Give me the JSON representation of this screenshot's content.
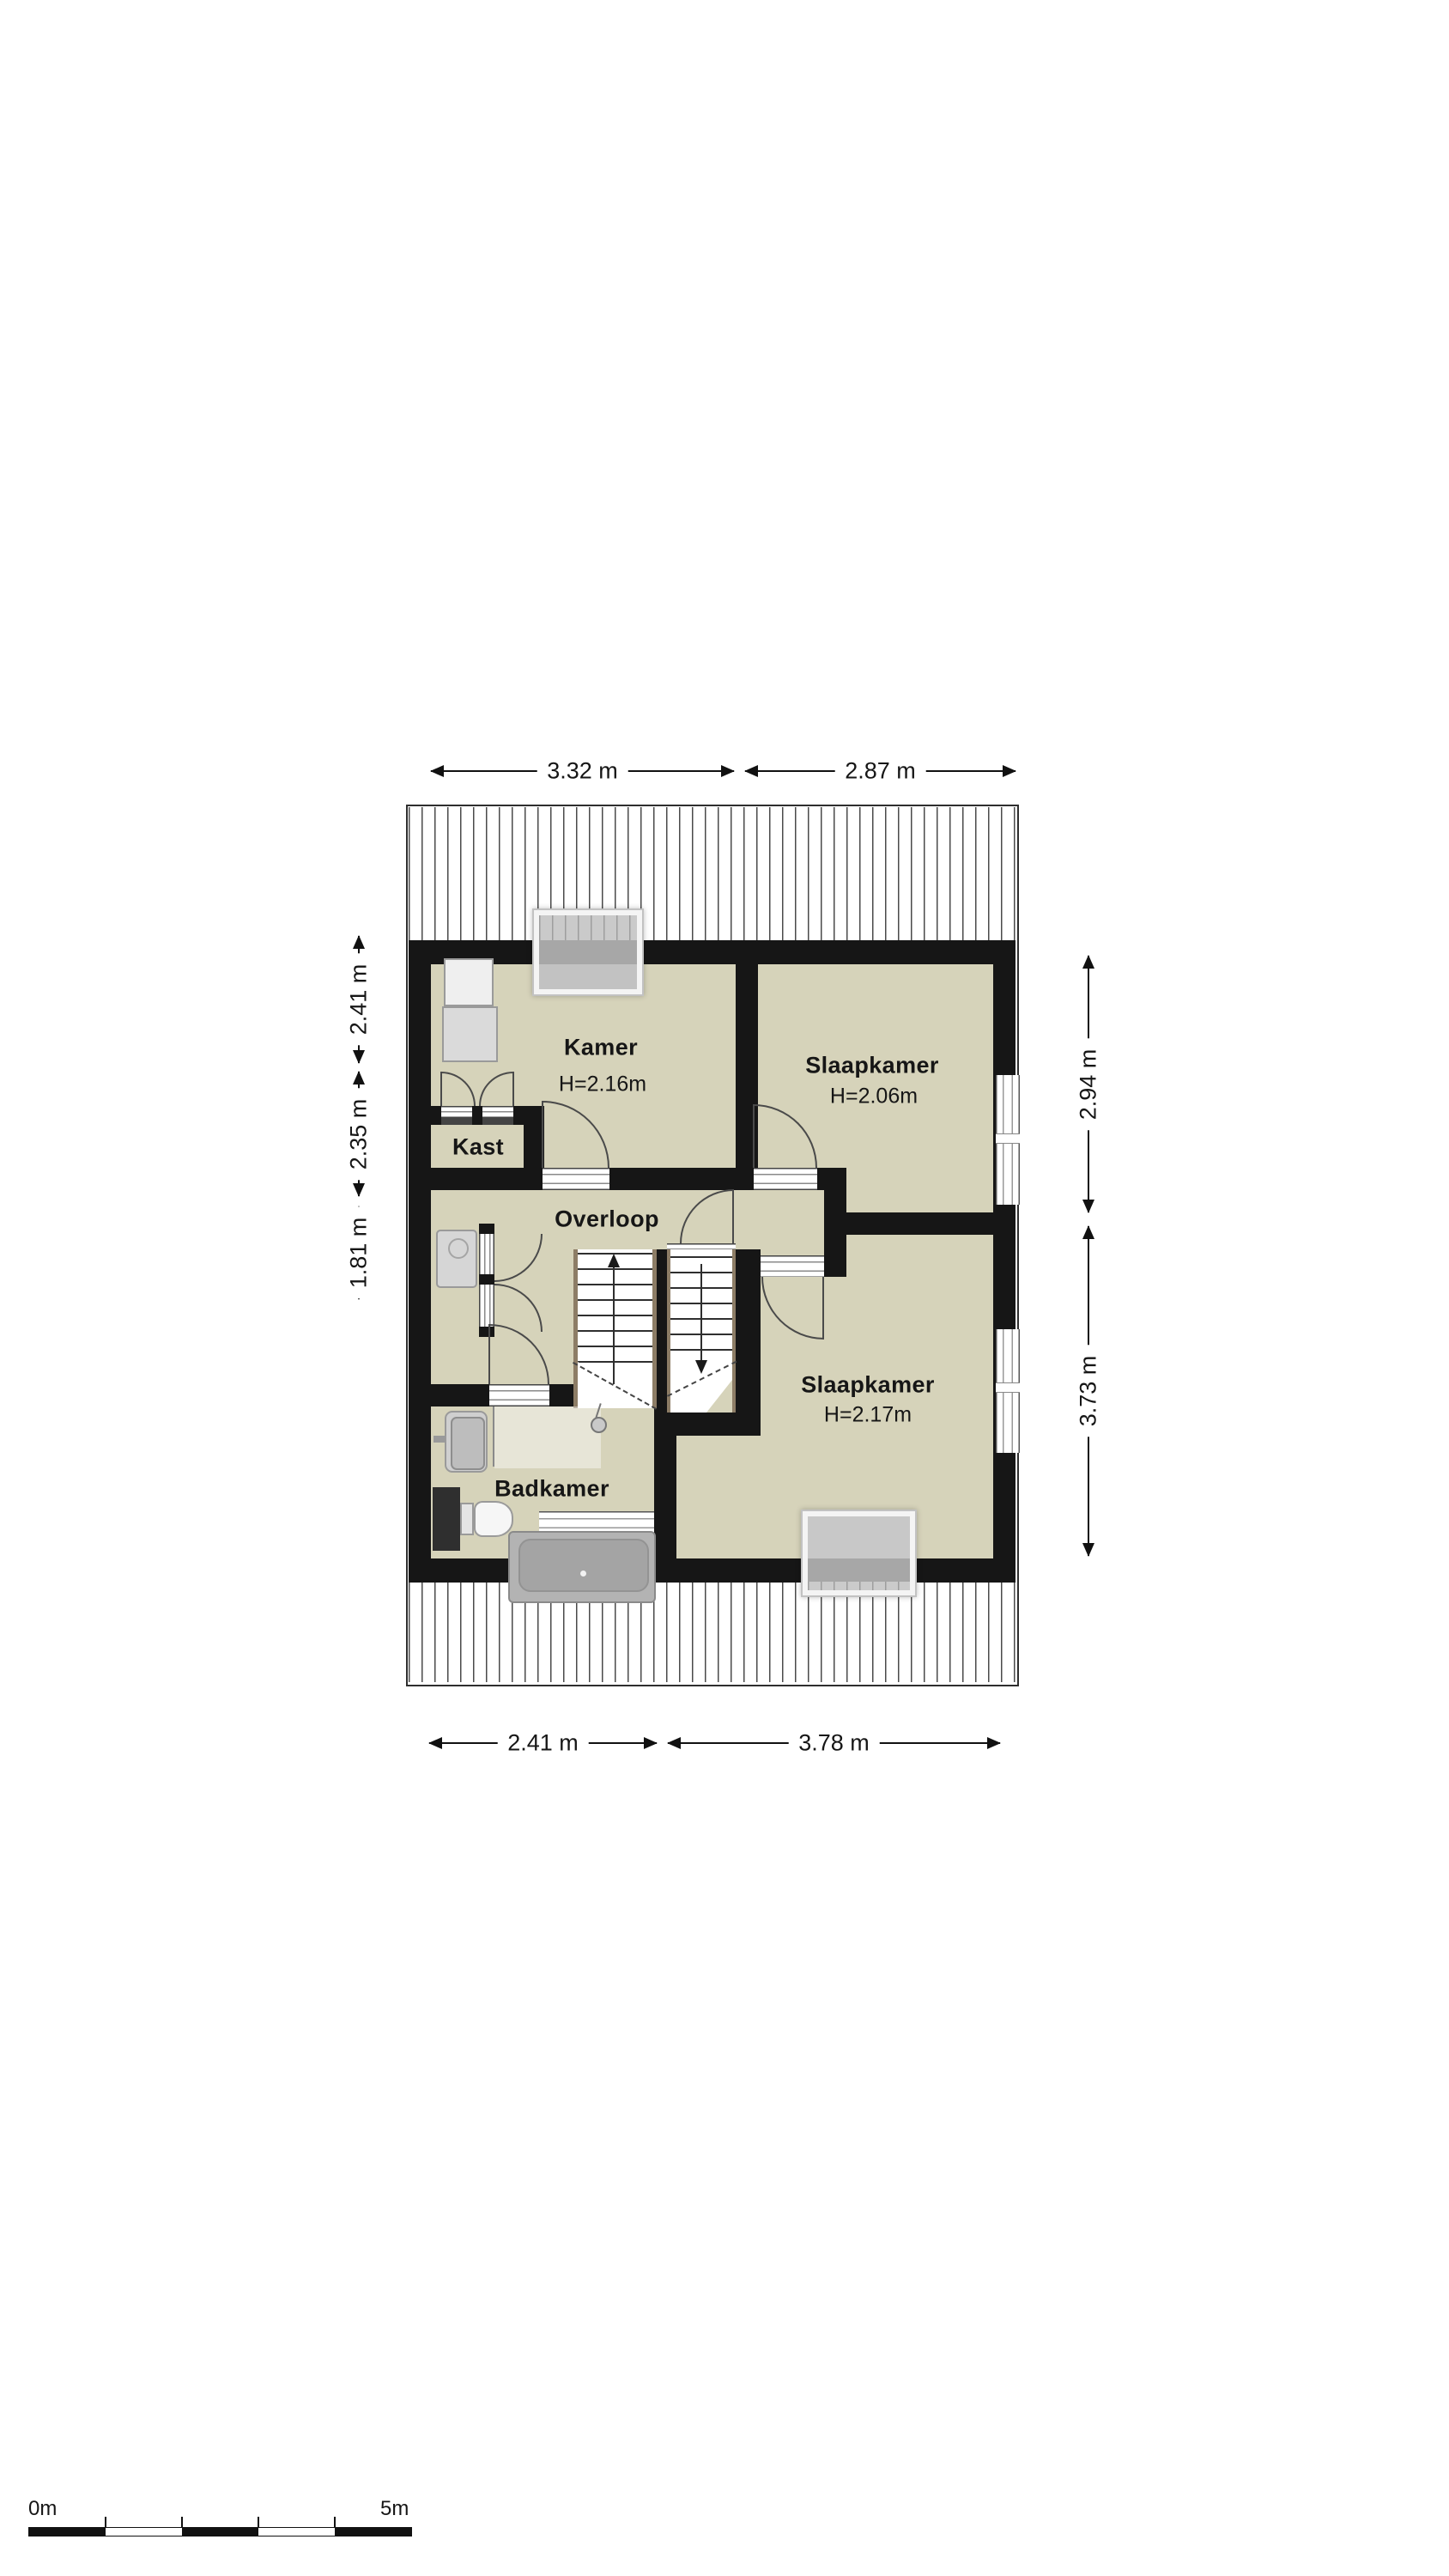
{
  "floorplan": {
    "rooms": [
      {
        "id": "kamer",
        "label": "Kamer",
        "height": "H=2.16m"
      },
      {
        "id": "slaapkamer-boven",
        "label": "Slaapkamer",
        "height": "H=2.06m"
      },
      {
        "id": "kast",
        "label": "Kast",
        "height": ""
      },
      {
        "id": "overloop",
        "label": "Overloop",
        "height": ""
      },
      {
        "id": "badkamer",
        "label": "Badkamer",
        "height": ""
      },
      {
        "id": "slaapkamer-onder",
        "label": "Slaapkamer",
        "height": "H=2.17m"
      }
    ],
    "dimensions": {
      "top": [
        "3.32 m",
        "2.87 m"
      ],
      "bottom": [
        "2.41 m",
        "3.78 m"
      ],
      "left": [
        "2.41 m",
        "2.35 m",
        "1.81 m"
      ],
      "right": [
        "2.94 m",
        "3.73 m"
      ]
    },
    "scale_bar": {
      "start": "0m",
      "end": "5m"
    },
    "colors": {
      "wall": "#161616",
      "floor": "#d6d3ba",
      "fixture_gray": "#c9c9c9"
    }
  }
}
